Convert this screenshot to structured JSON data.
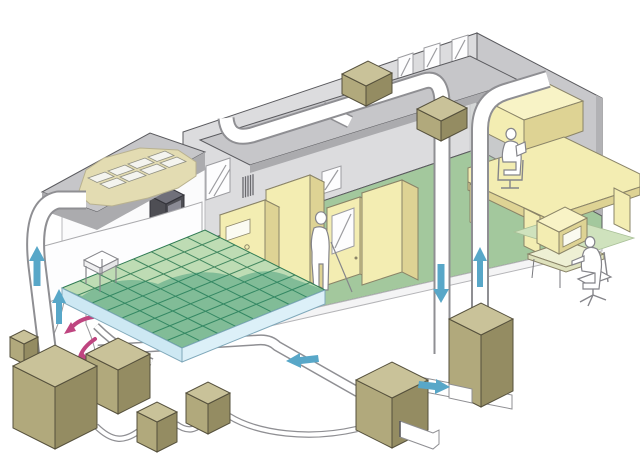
{
  "meta": {
    "description": "Isometric cutaway illustration of a building air-conditioning and cleanroom airflow system: cleanroom with raised access floor and ceiling filter modules, equipment room with control cabinets, office with desk, connected by white air ducts with blue airflow arrows, magenta underfloor recirculation arrows, khaki air-handling units, and a separate computer workstation vignette."
  },
  "palette": {
    "bg": "#ffffff",
    "outline": "#5a5a5e",
    "wall": "#dcdcde",
    "wall_right": "#c8c8cb",
    "wall_edge": "#b2b2b5",
    "roof_top": "#c6c6c9",
    "roof_fascia": "#ababae",
    "floor_green": "#a3c89d",
    "raised_tile": "#bedcb4",
    "raised_grid": "#2e7a52",
    "raised_tint": "#1d8a68",
    "fascia_light": "#cde8f3",
    "fascia_lighter": "#dcf0f8",
    "fascia_stroke": "#7fa8ba",
    "duct_fill": "#ffffff",
    "duct_stroke": "#8f8f93",
    "unit_top": "#c9c299",
    "unit_left": "#b1a97c",
    "unit_right": "#948c62",
    "unit_stroke": "#55503c",
    "cab_front": "#f3edb2",
    "cab_top": "#f8f3c6",
    "cab_side": "#ded394",
    "cab_stroke": "#8a8468",
    "window": "#fdfdfe",
    "slash": "#9c9ca0",
    "arrow_blue": "#58a7c8",
    "arrow_pink": "#bf4580",
    "person": "#ffffff",
    "person_stroke": "#85858a",
    "darkbox": "#4e4e54",
    "darkbox_top": "#70707a",
    "darkbox_inner": "#8b8b95",
    "filter_tan": "#e3dcb2",
    "tile": "#f4f4ef",
    "tile_stroke": "#8f8f82",
    "glass": "#c9cfcb",
    "vign_mat": "#cfe2bd",
    "vign_desk": "#eef0d4",
    "vign_desk_edge": "#dfe2bd"
  },
  "components": {
    "rooms": [
      "cleanroom-raised-floor",
      "equipment-room",
      "office"
    ],
    "equipment": [
      "ceiling-filter-modules",
      "wall-control-box",
      "control-cabinet-with-dials",
      "tall-cabinet",
      "door-unit-with-window",
      "large-cabinet",
      "office-desk",
      "overhead-cabinet"
    ],
    "air_handling_units": 7,
    "roof_diffuser_boxes": 2,
    "people": 3,
    "windows": 4
  },
  "airflow_arrows": [
    {
      "location": "far-left-riser-duct",
      "direction": "up",
      "color": "#58a7c8"
    },
    {
      "location": "underfloor-plenum-left",
      "direction": "up",
      "color": "#58a7c8"
    },
    {
      "location": "front-left-vertical-duct",
      "direction": "down",
      "color": "#58a7c8"
    },
    {
      "location": "front-right-vertical-duct",
      "direction": "up",
      "color": "#58a7c8"
    },
    {
      "location": "ground-return-duct",
      "direction": "left",
      "color": "#58a7c8"
    },
    {
      "location": "ahu-inlet-branch",
      "direction": "right",
      "color": "#58a7c8"
    },
    {
      "location": "underfloor-recirculation-1",
      "direction": "curved-left",
      "color": "#bf4580"
    },
    {
      "location": "underfloor-recirculation-2",
      "direction": "curved-down",
      "color": "#bf4580"
    }
  ]
}
